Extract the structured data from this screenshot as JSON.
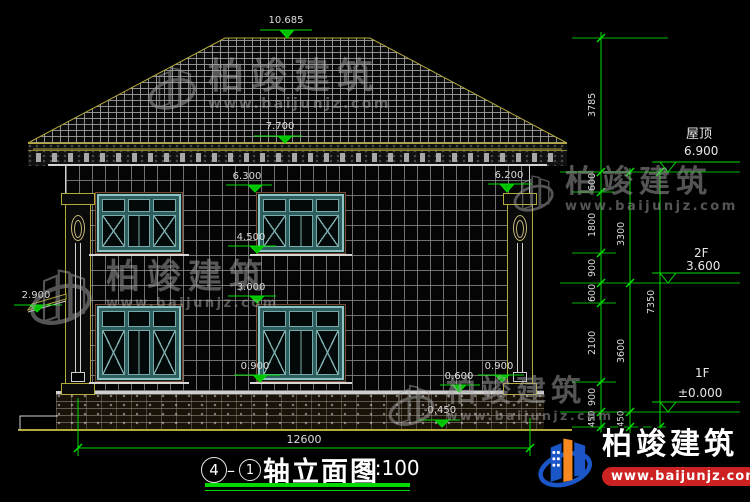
{
  "watermark": {
    "brand": "柏竣建筑",
    "url": "www.baijunjz.com"
  },
  "title": {
    "axis_start": "4",
    "dash": "–",
    "axis_end": "1",
    "name": "轴立面图",
    "scale": "1:100"
  },
  "marks": {
    "ridge": "10.685",
    "eave": "7.700",
    "win2_top": "6.300",
    "cap_right": "6.200",
    "win2_sill": "4.500",
    "win1_top": "3.000",
    "canopy_left": "2.900",
    "win1_sill": "0.900",
    "pipe_right": "0.900",
    "plinth": "0.600",
    "ground": "-0.450"
  },
  "levels": {
    "roof": {
      "label": "屋顶",
      "value": "6.900"
    },
    "f2": {
      "label": "2F",
      "value": "3.600"
    },
    "f1": {
      "label": "1F",
      "value": "±0.000"
    }
  },
  "dims": {
    "total_width": "12600",
    "chain_inner": [
      "3785",
      "600",
      "1800",
      "900",
      "600",
      "2100",
      "900",
      "450"
    ],
    "chain_middle": [
      "3300",
      "3600",
      "450"
    ],
    "chain_outer": [
      "7350"
    ]
  },
  "colors": {
    "line_green": "#00dc00",
    "roof_outline": "#b5aa3c",
    "window_teal": "#2e5d5d",
    "dim_text": "#dcdcdc",
    "watermark_gray": "#a8a8a8",
    "logo_blue": "#1a56c8",
    "logo_orange": "#f5891f",
    "url_band_red": "#cc2222"
  }
}
